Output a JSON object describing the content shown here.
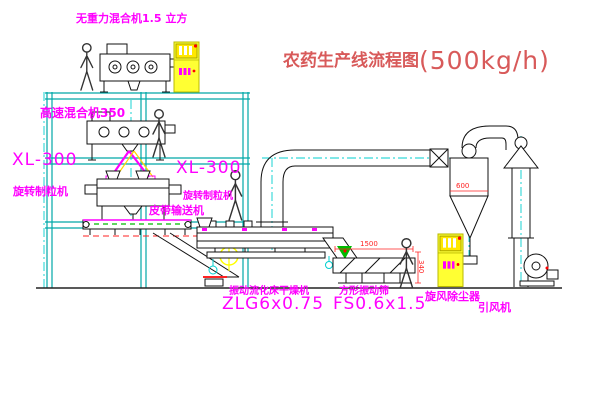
{
  "title": {
    "name": "农药生产线流程图",
    "capacity": "(500kg/h)"
  },
  "labels": {
    "top_mixer": "无重力混合机1.5 立方",
    "high_speed_mixer": "高速混合机350",
    "granulator_left_model": "XL-300",
    "granulator_left_name": "旋转制粒机",
    "granulator_right_model": "XL-300",
    "granulator_right_name": "旋转制粒机",
    "belt_conveyor": "皮带输送机",
    "dryer_name": "振动流化床干燥机",
    "dryer_model": "ZLG6x0.75",
    "sieve_name": "方形振动筛",
    "sieve_model": "FS0.6x1.5",
    "cyclone": "旋风除尘器",
    "fan": "引风机"
  },
  "dimensions": {
    "sieve_length": "1500",
    "sieve_height": "340",
    "cyclone_dia": "600"
  },
  "colors": {
    "structure": "#00A8A8",
    "label": "#FF00FF",
    "title": "#D85A5A",
    "dimension": "#FF2222",
    "cabinet": "#FFFF33",
    "target": "#FFFF00",
    "belt_green": "#00BB00"
  }
}
